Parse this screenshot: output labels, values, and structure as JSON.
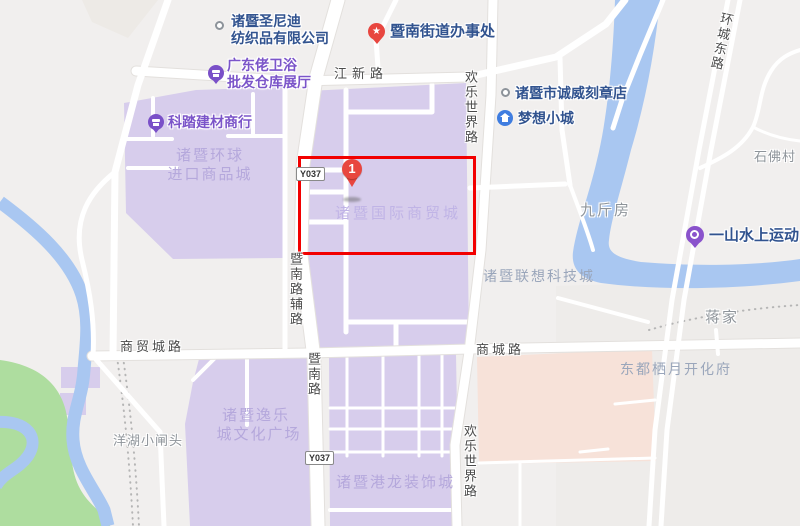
{
  "map": {
    "colors": {
      "highlight_box": "#f20000",
      "marker_red": "#e8463f",
      "purple_block": "#d7cdec",
      "pink_block": "#f7e2d9",
      "water": "#a9c7f1",
      "park_green": "#aedd9f",
      "road": "#ffffff",
      "poi_purple": "#7a50c8",
      "poi_blue": "#3f7de0",
      "text_blue": "#31538f",
      "text_purple": "#7b55c9",
      "area_text": "#b5a8dc"
    },
    "marker": {
      "label": "1"
    },
    "badges": {
      "north": "Y037",
      "south": "Y037"
    },
    "road_labels": {
      "jiangxin": "江新路",
      "shangmaocheng": "商贸城路",
      "shangcheng": "商城路",
      "jinan_fulu": "暨南路辅路",
      "jinan": "暨南路",
      "huanle_top": "欢乐世界路",
      "huanle_bottom": "欢乐世界路",
      "huancheng_dong": "环城东路"
    },
    "pois": {
      "shengnidi_l1": "诸暨圣尼迪",
      "shengnidi_l2": "纺织品有限公司",
      "jiedao": "暨南街道办事处",
      "kezhang": "诸暨市诚威刻章店",
      "mengxiang": "梦想小城",
      "yishan": "一山水上运动",
      "weiyu_l1": "广东佬卫浴",
      "weiyu_l2": "批发仓库展厅",
      "keta": "科踏建材商行"
    },
    "areas": {
      "huanqiu_l1": "诸暨环球",
      "huanqiu_l2": "进口商品城",
      "guoji": "诸暨国际商贸城",
      "yile_l1": "诸暨逸乐",
      "yile_l2": "城文化广场",
      "ganglong": "诸暨港龙装饰城",
      "lianxiang": "诸暨联想科技城",
      "dongdu": "东都栖月开化府"
    },
    "villages": {
      "jiujinfang": "九斤房",
      "shifocun": "石佛村",
      "jiangjia": "蒋家",
      "yanghu": "洋湖小闸头"
    }
  }
}
